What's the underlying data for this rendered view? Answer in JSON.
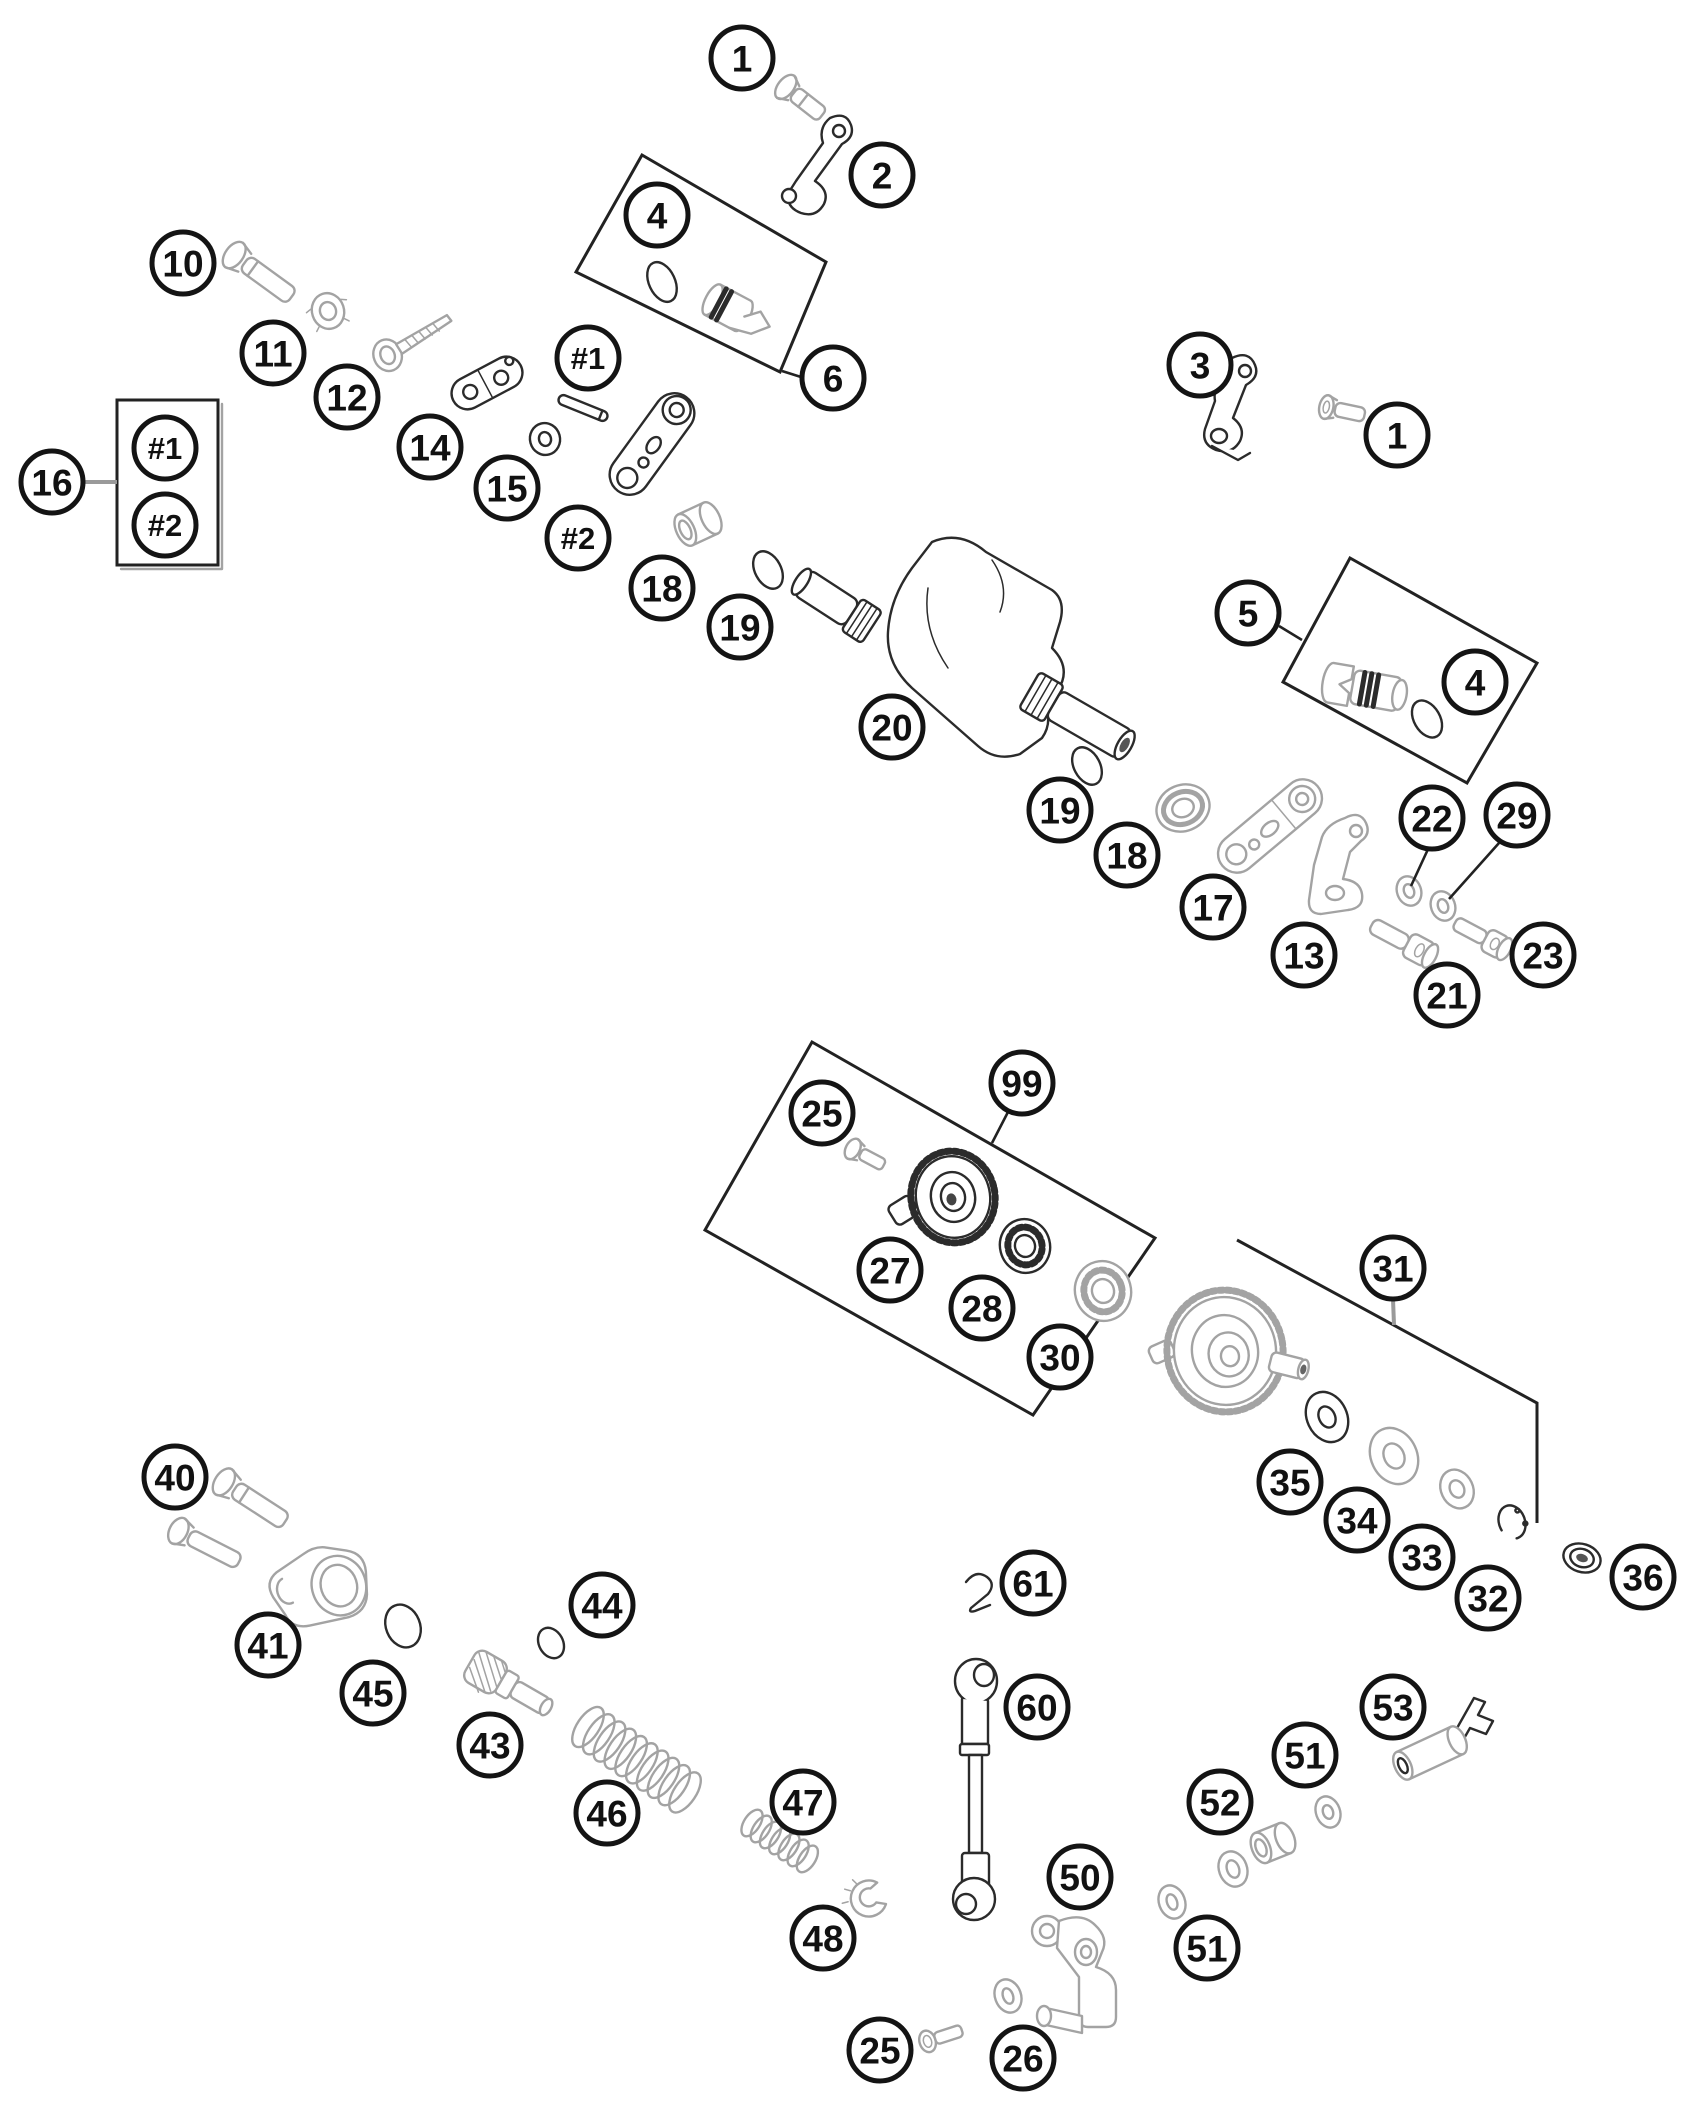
{
  "diagram": {
    "kind": "exploded-parts-diagram",
    "background_color": "#ffffff",
    "line_color": "#2b2b2b",
    "light_part_color": "#a3a3a3",
    "callout_style": {
      "radius": 31,
      "stroke_width": 5,
      "font_size_number": 37,
      "font_size_hash": 31
    },
    "callouts": [
      {
        "label": "1",
        "x": 742,
        "y": 58
      },
      {
        "label": "2",
        "x": 882,
        "y": 175
      },
      {
        "label": "4",
        "x": 657,
        "y": 215
      },
      {
        "label": "6",
        "x": 833,
        "y": 378
      },
      {
        "label": "3",
        "x": 1200,
        "y": 365
      },
      {
        "label": "1",
        "x": 1397,
        "y": 435
      },
      {
        "label": "10",
        "x": 183,
        "y": 263
      },
      {
        "label": "11",
        "x": 273,
        "y": 353
      },
      {
        "label": "12",
        "x": 347,
        "y": 397
      },
      {
        "label": "14",
        "x": 430,
        "y": 447
      },
      {
        "label": "15",
        "x": 507,
        "y": 488
      },
      {
        "label": "#1",
        "x": 588,
        "y": 358
      },
      {
        "label": "#2",
        "x": 578,
        "y": 538
      },
      {
        "label": "16",
        "x": 52,
        "y": 482
      },
      {
        "label": "#1",
        "x": 165,
        "y": 448
      },
      {
        "label": "#2",
        "x": 165,
        "y": 525
      },
      {
        "label": "18",
        "x": 662,
        "y": 588
      },
      {
        "label": "19",
        "x": 740,
        "y": 627
      },
      {
        "label": "20",
        "x": 892,
        "y": 727
      },
      {
        "label": "19",
        "x": 1060,
        "y": 810
      },
      {
        "label": "18",
        "x": 1127,
        "y": 855
      },
      {
        "label": "17",
        "x": 1213,
        "y": 907
      },
      {
        "label": "13",
        "x": 1304,
        "y": 955
      },
      {
        "label": "5",
        "x": 1248,
        "y": 613
      },
      {
        "label": "4",
        "x": 1475,
        "y": 682
      },
      {
        "label": "22",
        "x": 1432,
        "y": 818
      },
      {
        "label": "29",
        "x": 1517,
        "y": 815
      },
      {
        "label": "21",
        "x": 1447,
        "y": 995
      },
      {
        "label": "23",
        "x": 1543,
        "y": 955
      },
      {
        "label": "25",
        "x": 822,
        "y": 1113
      },
      {
        "label": "99",
        "x": 1022,
        "y": 1083
      },
      {
        "label": "27",
        "x": 890,
        "y": 1270
      },
      {
        "label": "28",
        "x": 982,
        "y": 1308
      },
      {
        "label": "30",
        "x": 1060,
        "y": 1357
      },
      {
        "label": "31",
        "x": 1393,
        "y": 1268
      },
      {
        "label": "35",
        "x": 1290,
        "y": 1482
      },
      {
        "label": "34",
        "x": 1357,
        "y": 1520
      },
      {
        "label": "33",
        "x": 1422,
        "y": 1557
      },
      {
        "label": "32",
        "x": 1488,
        "y": 1598
      },
      {
        "label": "36",
        "x": 1643,
        "y": 1577
      },
      {
        "label": "40",
        "x": 175,
        "y": 1477
      },
      {
        "label": "41",
        "x": 268,
        "y": 1645
      },
      {
        "label": "45",
        "x": 373,
        "y": 1693
      },
      {
        "label": "43",
        "x": 490,
        "y": 1745
      },
      {
        "label": "44",
        "x": 602,
        "y": 1605
      },
      {
        "label": "46",
        "x": 607,
        "y": 1813
      },
      {
        "label": "47",
        "x": 803,
        "y": 1802
      },
      {
        "label": "61",
        "x": 1033,
        "y": 1583
      },
      {
        "label": "60",
        "x": 1037,
        "y": 1707
      },
      {
        "label": "53",
        "x": 1393,
        "y": 1707
      },
      {
        "label": "51",
        "x": 1305,
        "y": 1755
      },
      {
        "label": "52",
        "x": 1220,
        "y": 1802
      },
      {
        "label": "50",
        "x": 1080,
        "y": 1877
      },
      {
        "label": "51",
        "x": 1207,
        "y": 1948
      },
      {
        "label": "48",
        "x": 823,
        "y": 1938
      },
      {
        "label": "25",
        "x": 880,
        "y": 2050
      },
      {
        "label": "26",
        "x": 1023,
        "y": 2058
      }
    ],
    "ref_boxes": [
      {
        "name": "legend-box-16",
        "points": "117,400 218,400 218,565 117,565",
        "open": false
      },
      {
        "name": "kit-box-4",
        "points": "642,155 826,262 780,372 576,272",
        "open": false
      },
      {
        "name": "kit-box-5",
        "points": "1350,558 1537,663 1467,783 1283,682",
        "open": false
      },
      {
        "name": "kit-box-99",
        "points": "812,1042 1155,1238 1033,1415 705,1230",
        "open": false
      },
      {
        "name": "bracket-31",
        "points": "1237,1240 1537,1403 1537,1523",
        "open": true
      }
    ],
    "leader_lines": [
      {
        "name": "leader-16",
        "x1": 83,
        "y1": 482,
        "x2": 117,
        "y2": 482,
        "light": true
      },
      {
        "name": "leader-6",
        "x1": 782,
        "y1": 371,
        "x2": 801,
        "y2": 377,
        "light": false
      },
      {
        "name": "leader-5",
        "x1": 1279,
        "y1": 626,
        "x2": 1302,
        "y2": 640,
        "light": false
      },
      {
        "name": "leader-22",
        "x1": 1429,
        "y1": 847,
        "x2": 1411,
        "y2": 886,
        "light": false
      },
      {
        "name": "leader-29",
        "x1": 1499,
        "y1": 843,
        "x2": 1449,
        "y2": 899,
        "light": false
      },
      {
        "name": "leader-99",
        "x1": 1008,
        "y1": 1112,
        "x2": 992,
        "y2": 1143,
        "light": false
      },
      {
        "name": "leader-31",
        "x1": 1393,
        "y1": 1299,
        "x2": 1394,
        "y2": 1325,
        "light": true
      }
    ]
  }
}
